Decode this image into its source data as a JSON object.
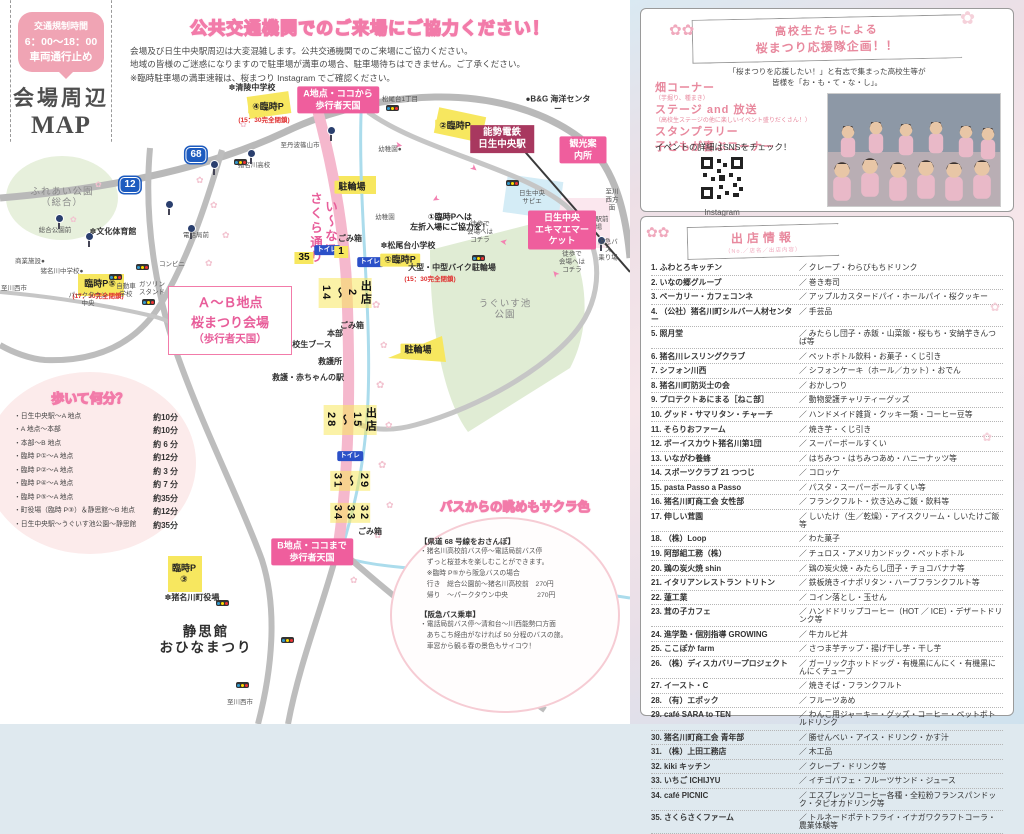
{
  "map_panel": {
    "banner": {
      "bubble_line1": "交通規制時間",
      "bubble_line2": "6：00～18：00",
      "bubble_line3": "車両通行止め",
      "title_line1": "会場周辺",
      "title_line2": "MAP"
    },
    "notice": {
      "title": "公共交通機関でのご来場にご協力ください！",
      "line1": "会場及び日生中央駅周辺は大変混雑します。公共交通機関でのご来場にご協力ください。",
      "line2": "地域の皆様のご迷惑になりますので駐車場が満車の場合、駐車場待ちはできません。ご了承ください。",
      "line3": "※臨時駐車場の満車速報は、桜まつり Instagram でご確認ください。"
    },
    "area_box": {
      "line1": "Ａ～Ｂ地点",
      "line2": "桜まつり会場",
      "line3": "（歩行者天国）"
    },
    "labels": [
      {
        "t": "至丹波篠山市",
        "x": 300,
        "y": 146,
        "c": "tiny"
      },
      {
        "t": "✽清陵中学校",
        "x": 252,
        "y": 88,
        "c": "plain"
      },
      {
        "t": "A地点・ココから\n歩行者天国",
        "x": 338,
        "y": 100,
        "c": "pinkbox"
      },
      {
        "t": "④臨時P",
        "x": 268,
        "y": 107,
        "c": "parking"
      },
      {
        "t": "(15：30完全閉鎖)",
        "x": 264,
        "y": 121,
        "c": "rednote"
      },
      {
        "t": "松尾台1丁目",
        "x": 400,
        "y": 100,
        "c": "tiny"
      },
      {
        "t": "②臨時P",
        "x": 455,
        "y": 126,
        "c": "parking"
      },
      {
        "t": "能勢電鉄\n日生中央駅",
        "x": 502,
        "y": 139,
        "c": "darkbox"
      },
      {
        "t": "観光案内所",
        "x": 583,
        "y": 150,
        "c": "pinkbox"
      },
      {
        "t": "●B&G 海洋センター",
        "x": 558,
        "y": 104,
        "c": "plain"
      },
      {
        "t": "幼稚園●",
        "x": 390,
        "y": 150,
        "c": "tiny"
      },
      {
        "t": "駐輪場",
        "x": 352,
        "y": 187,
        "c": "parking"
      },
      {
        "t": "い～な!!\nさくら通り",
        "x": 322,
        "y": 228,
        "c": "street"
      },
      {
        "t": "日生中央\nサピエ",
        "x": 532,
        "y": 198,
        "c": "tiny"
      },
      {
        "t": "日生中央駅前\n人の広場",
        "x": 589,
        "y": 224,
        "c": "tiny"
      },
      {
        "t": "阪急バス\n乗り場",
        "x": 608,
        "y": 250,
        "c": "tiny"
      },
      {
        "t": "徒歩で\n会場へは\nコチラ",
        "x": 480,
        "y": 232,
        "c": "tiny"
      },
      {
        "t": "徒歩で\n会場へは\nコチラ",
        "x": 572,
        "y": 262,
        "c": "tiny"
      },
      {
        "t": "幼稚園",
        "x": 385,
        "y": 218,
        "c": "tiny"
      },
      {
        "t": "①臨時Pへは\n左折入場にご協力を！",
        "x": 450,
        "y": 222,
        "c": "note"
      },
      {
        "t": "日生中央\nエキマエマーケット",
        "x": 562,
        "y": 230,
        "c": "pinkbox"
      },
      {
        "t": "✽松尾台小学校",
        "x": 408,
        "y": 246,
        "c": "plain"
      },
      {
        "t": "トイレ",
        "x": 370,
        "y": 262,
        "c": "toilet"
      },
      {
        "t": "①臨時P",
        "x": 400,
        "y": 260,
        "c": "parking"
      },
      {
        "t": "大型・中型バイク駐輪場",
        "x": 452,
        "y": 268,
        "c": "plain"
      },
      {
        "t": "(15：30完全閉鎖)",
        "x": 430,
        "y": 280,
        "c": "rednote"
      },
      {
        "t": "うぐいす池\n公園",
        "x": 505,
        "y": 310,
        "c": "parklabel"
      },
      {
        "t": "駐輪場",
        "x": 418,
        "y": 350,
        "c": "parking"
      },
      {
        "t": "ごみ箱",
        "x": 350,
        "y": 239,
        "c": "plain"
      },
      {
        "t": "トイレ",
        "x": 327,
        "y": 250,
        "c": "toilet"
      },
      {
        "t": "35",
        "x": 304,
        "y": 258,
        "c": "numbadge"
      },
      {
        "t": "1",
        "x": 341,
        "y": 252,
        "c": "numbadge"
      },
      {
        "t": "出店\n2\n～\n14",
        "x": 345,
        "y": 293,
        "c": "stall"
      },
      {
        "t": "ごみ箱",
        "x": 352,
        "y": 326,
        "c": "plain"
      },
      {
        "t": "本部",
        "x": 335,
        "y": 334,
        "c": "plain"
      },
      {
        "t": "高校生ブース",
        "x": 308,
        "y": 345,
        "c": "plain"
      },
      {
        "t": "救護所",
        "x": 330,
        "y": 362,
        "c": "plain"
      },
      {
        "t": "救護・赤ちゃんの駅",
        "x": 308,
        "y": 378,
        "c": "plain"
      },
      {
        "t": "出店\n15\n～\n28",
        "x": 350,
        "y": 420,
        "c": "stall"
      },
      {
        "t": "トイレ",
        "x": 350,
        "y": 456,
        "c": "toilet"
      },
      {
        "t": "29\n～\n31",
        "x": 350,
        "y": 481,
        "c": "stall"
      },
      {
        "t": "32\n33\n34",
        "x": 350,
        "y": 513,
        "c": "stall"
      },
      {
        "t": "ごみ箱",
        "x": 370,
        "y": 532,
        "c": "plain"
      },
      {
        "t": "B地点・ココまで\n歩行者天国",
        "x": 312,
        "y": 552,
        "c": "pinkbox"
      },
      {
        "t": "ふれあい公園\n（総合）",
        "x": 62,
        "y": 198,
        "c": "parklabel"
      },
      {
        "t": "12",
        "x": 130,
        "y": 185,
        "c": "shield"
      },
      {
        "t": "68",
        "x": 196,
        "y": 155,
        "c": "shield"
      },
      {
        "t": "猪名川高校",
        "x": 254,
        "y": 166,
        "c": "tiny"
      },
      {
        "t": "総合公園前",
        "x": 55,
        "y": 231,
        "c": "tiny"
      },
      {
        "t": "✽文化体育館",
        "x": 113,
        "y": 232,
        "c": "plain"
      },
      {
        "t": "臨時P⑤",
        "x": 100,
        "y": 284,
        "c": "parking"
      },
      {
        "t": "(17：30完全閉鎖)",
        "x": 98,
        "y": 297,
        "c": "rednote"
      },
      {
        "t": "商業施設●",
        "x": 30,
        "y": 262,
        "c": "tiny"
      },
      {
        "t": "猪名川中学校●",
        "x": 62,
        "y": 272,
        "c": "tiny"
      },
      {
        "t": "コンビニ",
        "x": 172,
        "y": 265,
        "c": "tiny"
      },
      {
        "t": "電話局前",
        "x": 196,
        "y": 236,
        "c": "tiny"
      },
      {
        "t": "ガソリン\nスタンド",
        "x": 152,
        "y": 289,
        "c": "tiny"
      },
      {
        "t": "自動車\n学校",
        "x": 126,
        "y": 291,
        "c": "tiny"
      },
      {
        "t": "パークタウン\n中央",
        "x": 88,
        "y": 300,
        "c": "tiny"
      },
      {
        "t": "至川西市",
        "x": 14,
        "y": 289,
        "c": "tiny"
      },
      {
        "t": "臨時P\n③",
        "x": 184,
        "y": 574,
        "c": "parking"
      },
      {
        "t": "✽猪名川町役場",
        "x": 192,
        "y": 598,
        "c": "plain"
      },
      {
        "t": "静思館\nおひなまつり",
        "x": 206,
        "y": 640,
        "c": "bigdark"
      },
      {
        "t": "至新名神高速道路\n川西IC",
        "x": 556,
        "y": 610,
        "c": "tiny"
      },
      {
        "t": "至川西市",
        "x": 240,
        "y": 703,
        "c": "tiny"
      },
      {
        "t": "至川西方面",
        "x": 612,
        "y": 200,
        "c": "tiny"
      }
    ],
    "walk": {
      "title": "歩いて何分？",
      "rows": [
        {
          "route": "・日生中央駅～A 地点",
          "time": "約10分"
        },
        {
          "route": "・A 地点～本部",
          "time": "約10分"
        },
        {
          "route": "・本部～B 地点",
          "time": "約 6 分"
        },
        {
          "route": "・臨時 P①～A 地点",
          "time": "約12分"
        },
        {
          "route": "・臨時 P②～A 地点",
          "time": "約 3 分"
        },
        {
          "route": "・臨時 P④～A 地点",
          "time": "約 7 分"
        },
        {
          "route": "・臨時 P⑤～A 地点",
          "time": "約35分"
        },
        {
          "route": "・町役場（臨時 P③）＆静思館～B 地点",
          "time": "約12分"
        },
        {
          "route": "・日生中央駅～うぐいす池公園～静思館",
          "time": "約35分"
        }
      ]
    },
    "bus": {
      "title": "バスからの眺めもサクラ色",
      "s1_title": "【県道 68 号線をおさんぽ】",
      "s1_lines": [
        "・猪名川高校前バス停～電話局前バス停",
        "　ずっと桜並木を楽しむことができます。",
        "　※臨時 P⑤から阪急バスの場合",
        "　行き　総合公園前～猪名川高校前　270円",
        "　帰り　～パークタウン中央　　　　 270円"
      ],
      "s2_title": "【阪急バス乗車】",
      "s2_lines": [
        "・電話局前バス停～清和台～川西能勢口方面",
        "　あちこち経由がなければ 50 分程のバスの旅。",
        "　車窓から観る春の景色もサイコウ！"
      ]
    }
  },
  "support_panel": {
    "ribbon_line1": "高校生たちによる",
    "ribbon_line2": "桜まつり応援隊企画！！",
    "subtitle_line1": "「桜まつりを応援したい！」と有志で集まった高校生等が",
    "subtitle_line2": "皆様を「お・も・て・な・し」。",
    "features": [
      {
        "name": "畑コーナー",
        "note": "（芋掘り、種まき）"
      },
      {
        "name": "ステージ and 放送",
        "note": "（高校生ステージの他に楽しいイベント盛りだくさん！）"
      },
      {
        "name": "スタンプラリー",
        "note": ""
      },
      {
        "name": "子どもが喜ぶコーナー",
        "note": ""
      }
    ],
    "sns_note": "イベントの詳細はSNSをチェック！",
    "qr_caption": "Instagram"
  },
  "shops_panel": {
    "title": "出店情報",
    "subtitle": "（No.／店名／出店内容）",
    "slash": "／",
    "shops": [
      {
        "no": "1.",
        "name": "ふわとろキッチン",
        "items": "クレープ・わらびもちドリンク"
      },
      {
        "no": "2.",
        "name": "いなの郷グループ",
        "items": "巻き寿司"
      },
      {
        "no": "3.",
        "name": "ベーカリー・カフェコンネ",
        "items": "アップルカスタードパイ・ホールパイ・桜クッキー"
      },
      {
        "no": "4.",
        "name": "（公社）猪名川町シルバー人材センター",
        "items": "手芸品"
      },
      {
        "no": "5.",
        "name": "照月堂",
        "items": "みたらし団子・赤飯・山菜飯・桜もち・安納芋きんつば等"
      },
      {
        "no": "6.",
        "name": "猪名川レスリングクラブ",
        "items": "ペットボトル飲料・お菓子・くじ引き"
      },
      {
        "no": "7.",
        "name": "シフォン川西",
        "items": "シフォンケーキ（ホール／カット）・おでん"
      },
      {
        "no": "8.",
        "name": "猪名川町防災士の会",
        "items": "おかしつり"
      },
      {
        "no": "9.",
        "name": "プロテクトあにまる［ねこ部］",
        "items": "動物愛護チャリティーグッズ"
      },
      {
        "no": "10.",
        "name": "グッド・サマリタン・チャーチ",
        "items": "ハンドメイド雑貨・クッキー類・コーヒー豆等"
      },
      {
        "no": "11.",
        "name": "そらりおファーム",
        "items": "焼き芋・くじ引き"
      },
      {
        "no": "12.",
        "name": "ボーイスカウト猪名川第1団",
        "items": "スーパーボールすくい"
      },
      {
        "no": "13.",
        "name": "いながわ養蜂",
        "items": "はちみつ・はちみつあめ・ハニーナッツ等"
      },
      {
        "no": "14.",
        "name": "スポーツクラブ 21 つつじ",
        "items": "コロッケ"
      },
      {
        "no": "15.",
        "name": "pasta Passo a Passo",
        "items": "パスタ・スーパーボールすくい等"
      },
      {
        "no": "16.",
        "name": "猪名川町商工会 女性部",
        "items": "フランクフルト・炊き込みご飯・飲料等"
      },
      {
        "no": "17.",
        "name": "伸しい茸園",
        "items": "しいたけ（生／乾燥）・アイスクリーム・しいたけご飯等"
      },
      {
        "no": "18.",
        "name": "（株）Loop",
        "items": "わた菓子"
      },
      {
        "no": "19.",
        "name": "阿部組工務（株）",
        "items": "チュロス・アメリカンドック・ペットボトル"
      },
      {
        "no": "20.",
        "name": "鶏の炭火焼 shin",
        "items": "鶏の炭火焼・みたらし団子・チョコバナナ等"
      },
      {
        "no": "21.",
        "name": "イタリアンレストラン トリトン",
        "items": "鉄板焼きイナポリタン・ハーブフランクフルト等"
      },
      {
        "no": "22.",
        "name": "蓮工業",
        "items": "コイン落とし・玉せん"
      },
      {
        "no": "23.",
        "name": "茸の子カフェ",
        "items": "ハンドドリップコーヒー（HOT ／ ICE）・デザートドリンク等"
      },
      {
        "no": "24.",
        "name": "進学塾・個別指導 GROWING",
        "items": "牛カルビ丼"
      },
      {
        "no": "25.",
        "name": "ここぽか farm",
        "items": "さつま芋チップ・揚げ干し芋・干し芋"
      },
      {
        "no": "26.",
        "name": "（株）ディスカバリープロジェクト",
        "items": "ガーリックホットドッグ・有機黒にんにく・有機黒にんにくチューブ"
      },
      {
        "no": "27.",
        "name": "イースト・C",
        "items": "焼きそば・フランクフルト"
      },
      {
        "no": "28.",
        "name": "（有）エポック",
        "items": "フルーツあめ"
      },
      {
        "no": "29.",
        "name": "café SARA to TEN",
        "items": "わんこ用ジャーキー・グッズ・コーヒー・ペットボトルドリンク"
      },
      {
        "no": "30.",
        "name": "猪名川町商工会 青年部",
        "items": "勝せんべい・アイス・ドリンク・かす汁"
      },
      {
        "no": "31.",
        "name": "（株）上田工務店",
        "items": "木工品"
      },
      {
        "no": "32.",
        "name": "kiki キッチン",
        "items": "クレープ・ドリンク等"
      },
      {
        "no": "33.",
        "name": "いちご ICHIJYU",
        "items": "イチゴパフェ・フルーツサンド・ジュース"
      },
      {
        "no": "34.",
        "name": "café PICNIC",
        "items": "エスプレッソコーヒー各種・全粒粉フランスパンドック・タピオカドリンク等"
      },
      {
        "no": "35.",
        "name": "さくらさくファーム",
        "items": "トルネードポテトフライ・イナガワクラフトコーラ・農業体験等"
      }
    ]
  },
  "colors": {
    "accent_pink": "#ef5e9d",
    "dark_station": "#a8385f",
    "parking_yellow": "#f7e75f",
    "toilet_blue": "#2b50c8",
    "shield_blue": "#1d5bbf"
  },
  "icons": {
    "traffic_light": "traffic-light",
    "bus_stop": "bus-stop",
    "sakura": "✿",
    "qr": "qr-code"
  }
}
